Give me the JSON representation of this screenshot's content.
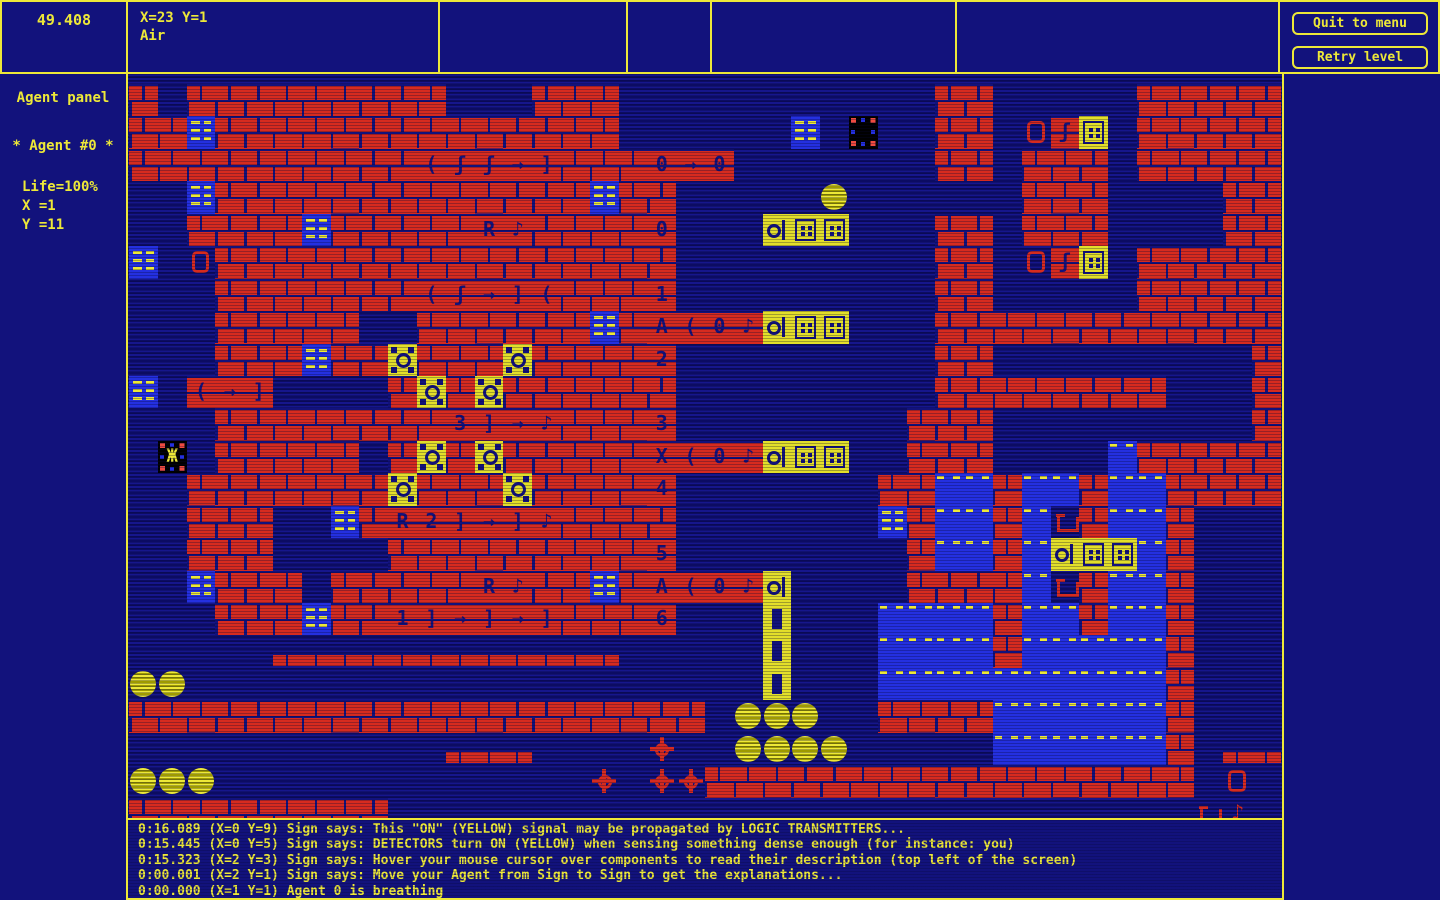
{
  "colors": {
    "background_navy": "#12127c",
    "accent_yellow": "#ede838",
    "brick_red": "#d62b1f",
    "signal_blue": "#2430e0",
    "agent_black": "#000000"
  },
  "top_bar": {
    "timer": "49.408",
    "hover_info": {
      "coords": "X=23 Y=1",
      "material": "Air"
    }
  },
  "menu": {
    "quit_label": "Quit to menu",
    "retry_label": "Retry level"
  },
  "agent_panel": {
    "title": "Agent panel",
    "agent_header": "* Agent #0  *",
    "life": "Life=100%",
    "x": "X  =1",
    "y": "Y  =11"
  },
  "log": {
    "lines": [
      "0:16.089 (X=0 Y=9) Sign says: This \"ON\" (YELLOW) signal may be propagated by LOGIC TRANSMITTERS...",
      "0:15.445 (X=0 Y=5) Sign says: DETECTORS turn ON (YELLOW) when sensing something dense enough (for instance: you)",
      "0:15.323 (X=2 Y=3) Sign says: Hover your mouse cursor over components to read their description (top left of the screen)",
      "0:00.001 (X=2 Y=1) Sign says: Move your Agent from Sign to Sign to get the explanations...",
      "0:00.000 (X=1 Y=1) Agent 0 is breathing"
    ]
  },
  "map": {
    "cols": 40,
    "rows_count": 23,
    "legend": {
      ".": {
        "cls": "empty",
        "name": "air"
      },
      "#": {
        "cls": "wall",
        "name": "brick-wall"
      },
      "h": {
        "cls": "ledge",
        "name": "brick-ledge"
      },
      "S": {
        "cls": "sign",
        "name": "sign"
      },
      "a": {
        "cls": "agent",
        "name": "agent-0",
        "glyph": "Ж"
      },
      "e": {
        "cls": "dock",
        "name": "agent-dock"
      },
      "B": {
        "cls": "ball",
        "name": "yellow-ball"
      },
      "D": {
        "cls": "detector",
        "name": "detector-on"
      },
      "J": {
        "cls": "txhead",
        "name": "transmitter-head-on"
      },
      "K": {
        "cls": "txbox",
        "name": "transmitter-box-on"
      },
      "V": {
        "cls": "duct",
        "name": "vertical-duct-on"
      },
      "W": {
        "cls": "water",
        "name": "water"
      },
      "C": {
        "cls": "mine",
        "name": "spiked-mine"
      },
      "d": {
        "cls": "door",
        "name": "red-door-frame"
      },
      "P": {
        "cls": "pot",
        "name": "red-pot"
      },
      "n": {
        "cls": "rednote",
        "name": "red-note",
        "glyph": "♪"
      },
      "O": {
        "cls": "chip",
        "name": "chip-0",
        "glyph": "0"
      },
      "1": {
        "cls": "chip",
        "name": "chip-1",
        "glyph": "1"
      },
      "2": {
        "cls": "chip",
        "name": "chip-2",
        "glyph": "2"
      },
      "3": {
        "cls": "chip",
        "name": "chip-3",
        "glyph": "3"
      },
      "4": {
        "cls": "chip",
        "name": "chip-4",
        "glyph": "4"
      },
      "5": {
        "cls": "chip",
        "name": "chip-5",
        "glyph": "5"
      },
      "6": {
        "cls": "chip",
        "name": "chip-6",
        "glyph": "6"
      },
      "A": {
        "cls": "chip",
        "name": "chip-A",
        "glyph": "A"
      },
      "X": {
        "cls": "chip",
        "name": "chip-X",
        "glyph": "X"
      },
      "R": {
        "cls": "chip",
        "name": "chip-R",
        "glyph": "R"
      },
      "[": {
        "cls": "chip",
        "name": "chip-bracket-open",
        "glyph": "("
      },
      "]": {
        "cls": "chip",
        "name": "chip-bracket-close",
        "glyph": "]"
      },
      "M": {
        "cls": "chip",
        "name": "chip-arrow",
        "glyph": "→"
      },
      "f": {
        "cls": "chip",
        "name": "chip-curl",
        "glyph": "ʃ"
      },
      "N": {
        "cls": "chip",
        "name": "chip-note",
        "glyph": "♪"
      }
    },
    "rows": [
      "#.#########...###...........##.....#####",
      "##S##############......S.e..##.dfK.#####",
      "##########[ffM]###OMO.......##.###.#####",
      "..S#############S##.....B......###....##",
      "..####S#####RN####O...JKK...##.###....##",
      "S.d################.........##.dfK.#####",
      "...#######[fM][###1.........##.....#####",
      "...#####..######S#A[ONJKK...############",
      "...###S##D###D####2.........##.........#",
      "S.[M]....#D#D######.........########...#",
      "...########3]MN###3........###.........#",
      ".a.#####.#D#D#####X[ONJKK..###....W#####",
      "..#######D###D####4.......##WW#WW#WW####",
      "..###..S#R2]M]N####.......S#WW#WP#WW#...",
      "..###....#########5........#WW#WJKKW#...",
      "..S###.#####RN##S#A[ONJ....####WP#WW#...",
      "...###S##1]M]M]###6...V...WWWW#WW#WW#...",
      ".....hhhhhhhhhhhh.....V...WWWW#WWWWW#...",
      "BB....................V...WWWWWWWWWW#...",
      "####################.BBB..####WWWWWW#...",
      "...........hhh....C..BBBB.....WWWWWW#.hh",
      "BBB.............C.CC#################.d.",
      "#########............................Pn."
    ]
  }
}
